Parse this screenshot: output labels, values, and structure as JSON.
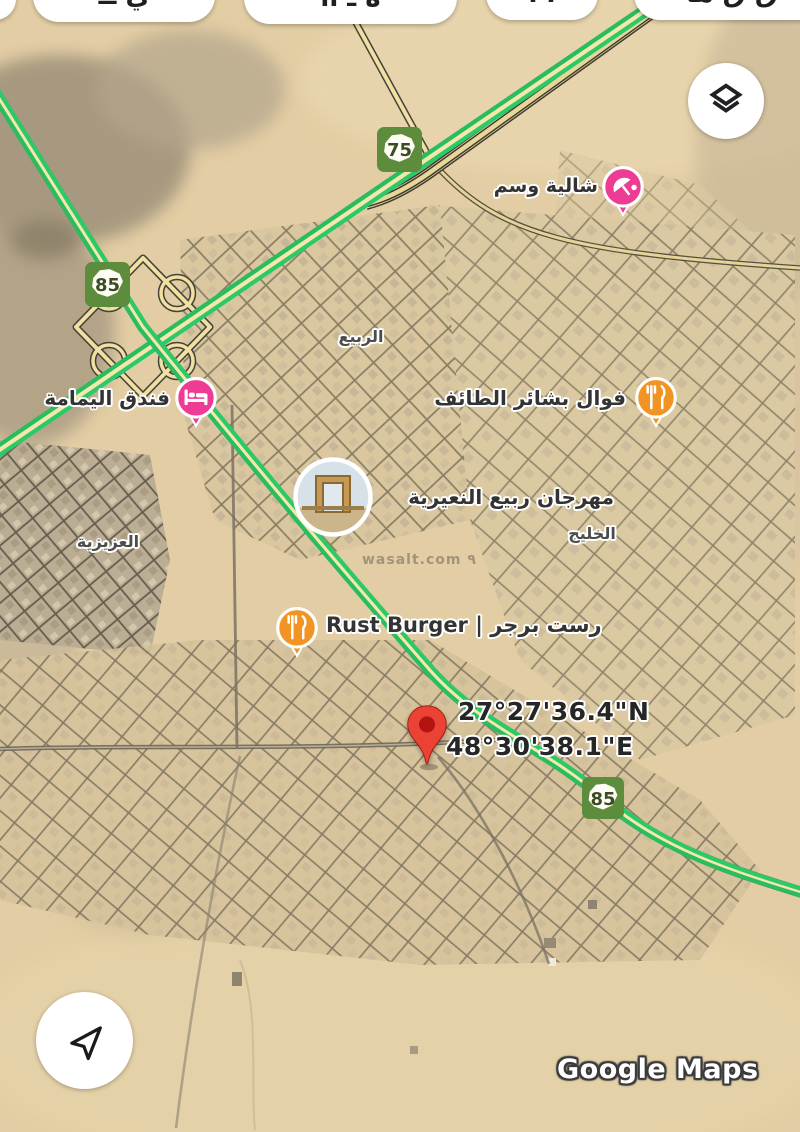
{
  "watermarks": {
    "provider": "Google Maps",
    "site": "wasalt.com ٩"
  },
  "top_chips": [
    {
      "glyph_hint": ""
    },
    {
      "glyph_hint": "ي ــ"
    },
    {
      "glyph_hint": "ة ـ اا"
    },
    {
      "glyph_hint": "ا ا"
    },
    {
      "glyph_hint": "ق ق ها"
    }
  ],
  "shields": [
    {
      "number": "75"
    },
    {
      "number": "85"
    },
    {
      "number": "85"
    }
  ],
  "pois": [
    {
      "name": "شالية وسم",
      "type": "chalet"
    },
    {
      "name": "فندق اليمامة",
      "type": "hotel"
    },
    {
      "name": "فوال بشائر الطائف",
      "type": "restaurant"
    },
    {
      "name": "مهرجان ربيع النعيرية",
      "type": "attraction"
    },
    {
      "name": "Rust Burger | رست برجر",
      "type": "restaurant"
    }
  ],
  "area_labels": [
    {
      "name": "الربيع"
    },
    {
      "name": "العزيزية"
    },
    {
      "name": "الخليج"
    }
  ],
  "marker": {
    "lat": "27°27'36.4\"N",
    "lng": "48°30'38.1\"E"
  },
  "colors": {
    "traffic_green": "#2cc968",
    "road_yellow": "#f5e6ac",
    "shield_green": "#5d8c3c",
    "poi_pink": "#ee3b94",
    "poi_orange": "#f29424",
    "pin_red": "#ea4335"
  }
}
